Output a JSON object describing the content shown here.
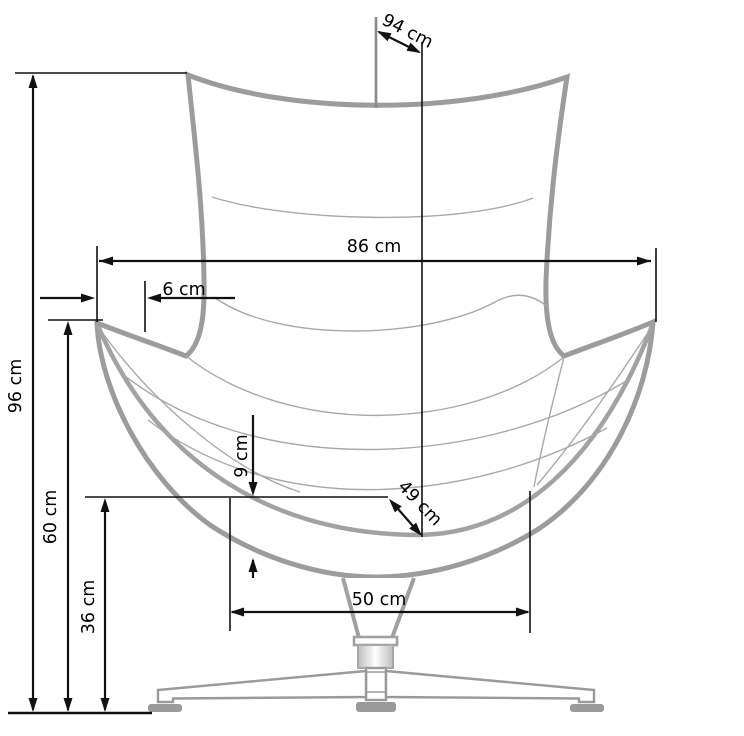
{
  "diagram": {
    "type": "furniture-dimension-drawing",
    "subject": "Egg-style upholstered swivel armchair, front view",
    "unit": "cm",
    "dimensions": [
      {
        "id": "back-depth-diagonal",
        "label": "94 cm",
        "value": 94,
        "orientation": "diagonal"
      },
      {
        "id": "overall-width",
        "label": "86 cm",
        "value": 86,
        "orientation": "horizontal"
      },
      {
        "id": "armrest-offset",
        "label": "6 cm",
        "value": 6,
        "orientation": "horizontal"
      },
      {
        "id": "overall-height",
        "label": "96 cm",
        "value": 96,
        "orientation": "vertical"
      },
      {
        "id": "armrest-height",
        "label": "60 cm",
        "value": 60,
        "orientation": "vertical"
      },
      {
        "id": "seat-height",
        "label": "36 cm",
        "value": 36,
        "orientation": "vertical"
      },
      {
        "id": "seat-shell-thickness",
        "label": "9 cm",
        "value": 9,
        "orientation": "vertical"
      },
      {
        "id": "seat-depth-diagonal",
        "label": "49 cm",
        "value": 49,
        "orientation": "diagonal"
      },
      {
        "id": "base-width",
        "label": "50 cm",
        "value": 50,
        "orientation": "horizontal"
      }
    ],
    "style": {
      "background": "#ffffff",
      "dimension_line_color": "#111111",
      "shell_outline_color": "#9c9c9c",
      "seam_color": "#a8a8a8",
      "upholstery_pattern": "plus-cross",
      "upholstery_pattern_color": "#b6b6b6"
    }
  }
}
